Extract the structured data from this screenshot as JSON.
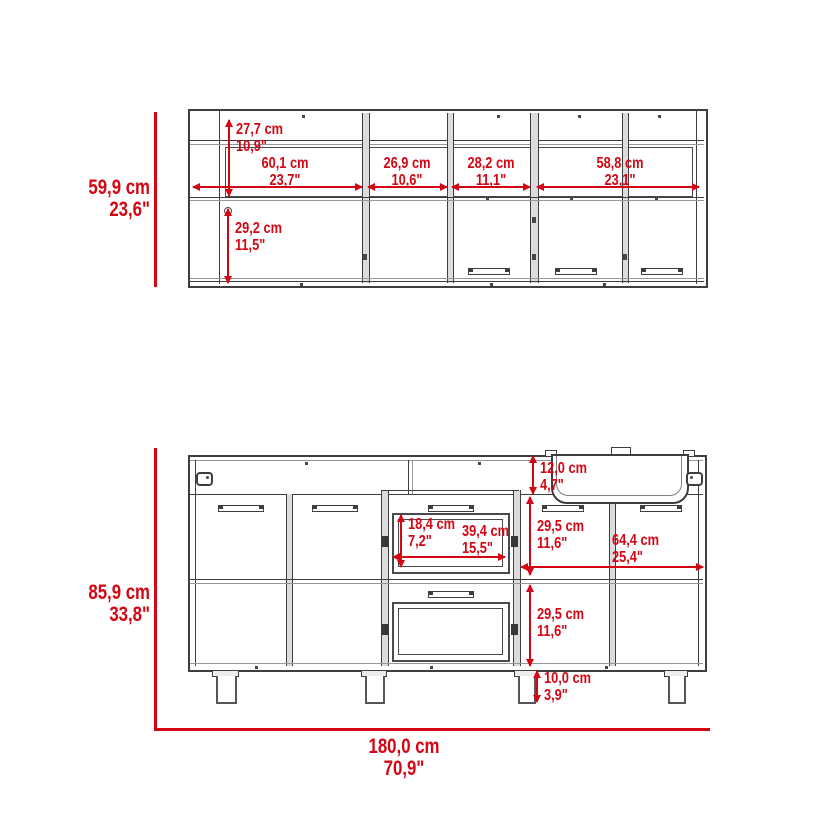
{
  "colors": {
    "dimension_red": "#d40613",
    "line_dark": "#3e3e40"
  },
  "upper_view": {
    "overall_height": {
      "cm": "59,9 cm",
      "in": "23,6\""
    },
    "interior_top_height": {
      "cm": "27,7 cm",
      "in": "10,9\""
    },
    "door_height": {
      "cm": "29,2 cm",
      "in": "11,5\""
    },
    "sections": [
      {
        "cm": "60,1 cm",
        "in": "23,7\""
      },
      {
        "cm": "26,9 cm",
        "in": "10,6\""
      },
      {
        "cm": "28,2 cm",
        "in": "11,1\""
      },
      {
        "cm": "58,8 cm",
        "in": "23,1\""
      }
    ]
  },
  "lower_view": {
    "overall_height": {
      "cm": "85,9 cm",
      "in": "33,8\""
    },
    "overall_width": {
      "cm": "180,0 cm",
      "in": "70,9\""
    },
    "top_rail_height": {
      "cm": "12,0 cm",
      "in": "4,7\""
    },
    "upper_door_height": {
      "cm": "29,5 cm",
      "in": "11,6\""
    },
    "oven_window_height": {
      "cm": "18,4 cm",
      "in": "7,2\""
    },
    "oven_window_width": {
      "cm": "39,4 cm",
      "in": "15,5\""
    },
    "right_section_width": {
      "cm": "64,4 cm",
      "in": "25,4\""
    },
    "lower_door_height": {
      "cm": "29,5 cm",
      "in": "11,6\""
    },
    "leg_height": {
      "cm": "10,0 cm",
      "in": "3,9\""
    }
  }
}
